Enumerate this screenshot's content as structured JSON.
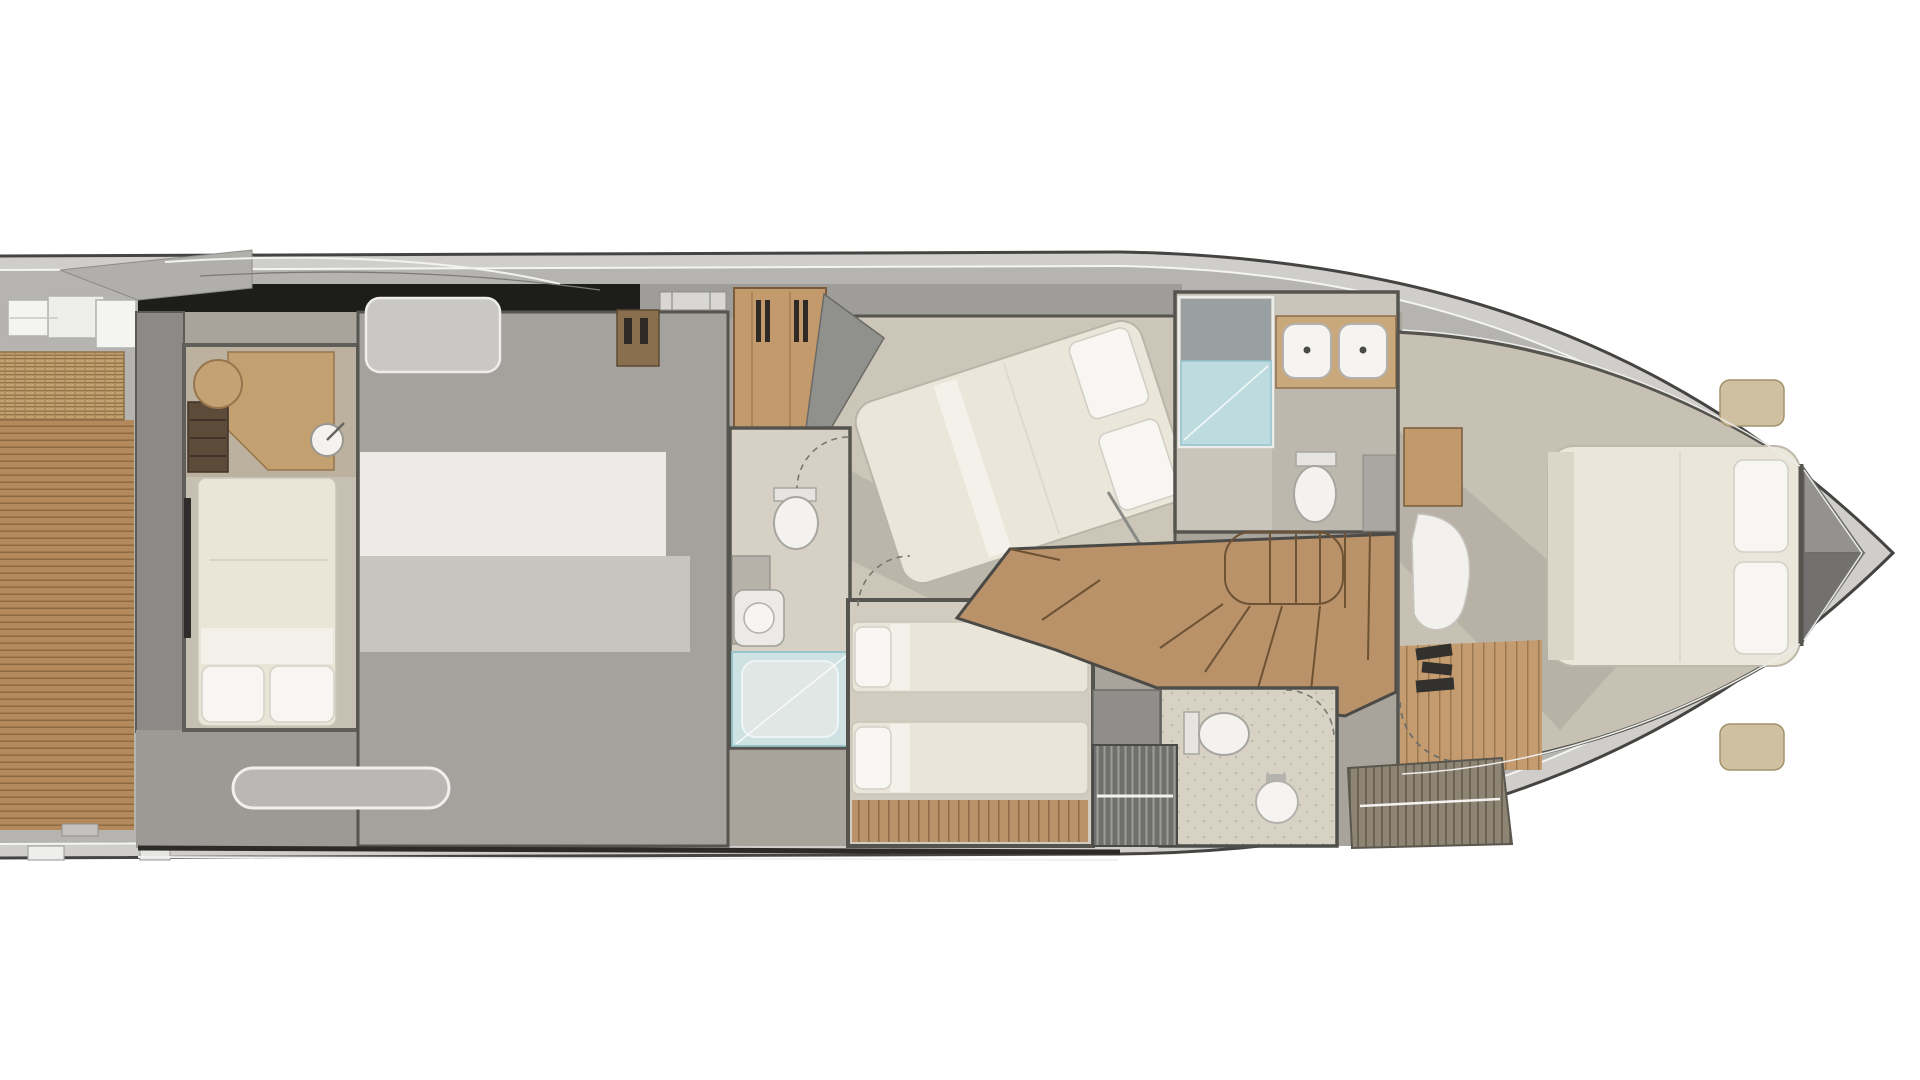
{
  "page": {
    "title": "Motor yacht lower deck floor plan"
  },
  "diagram": {
    "type": "floor-plan",
    "view": "top-down lower deck accommodation plan, bow pointing right",
    "regions": [
      {
        "id": "aft-deck",
        "label": "Aft deck with teak planking and wicker sunpad"
      },
      {
        "id": "aft-cabin",
        "label": "Aft cabin with single berth, desk, stool and washbasin"
      },
      {
        "id": "engine-room",
        "label": "Engine room and tender garage"
      },
      {
        "id": "vip-cabin",
        "label": "VIP guest cabin with angled double berth and hanging wardrobe"
      },
      {
        "id": "guest-bathroom",
        "label": "Guest bathroom with toilet, washbasin and glass shower"
      },
      {
        "id": "twin-cabin",
        "label": "Twin guest cabin with two single berths"
      },
      {
        "id": "midship-bathroom",
        "label": "Day head with twin washbasins, glass shower and toilet"
      },
      {
        "id": "staircase",
        "label": "Curved wooden companionway staircase"
      },
      {
        "id": "master-cabin",
        "label": "Forward master cabin with island double berth, TV unit and lounge chair"
      },
      {
        "id": "master-bathroom",
        "label": "Master bathroom with toilet and round washbasin"
      },
      {
        "id": "foredeck",
        "label": "Bow foredeck with anchor locker"
      }
    ],
    "counts": {
      "cabins": 4,
      "bathrooms": 3,
      "berths": 5
    },
    "palette": {
      "background": "#ffffff",
      "hull_rim": "#cfcecb",
      "deck_gray": "#b5b4b0",
      "gunwale_black": "#1d1d1b",
      "wall_gray": "#55544f",
      "floor_beige": "#ccc6b9",
      "teak": "#b4895c",
      "stair_wood": "#b9926a",
      "wicker": "#c2a270",
      "bed_cream": "#eae6d9",
      "pillow_white": "#f7f6f2",
      "porcelain": "#f3f2ef",
      "shower_glass": "#bedee3",
      "cabinet_wood": "#c2996a",
      "grate_dark": "#6f6f6d"
    }
  }
}
